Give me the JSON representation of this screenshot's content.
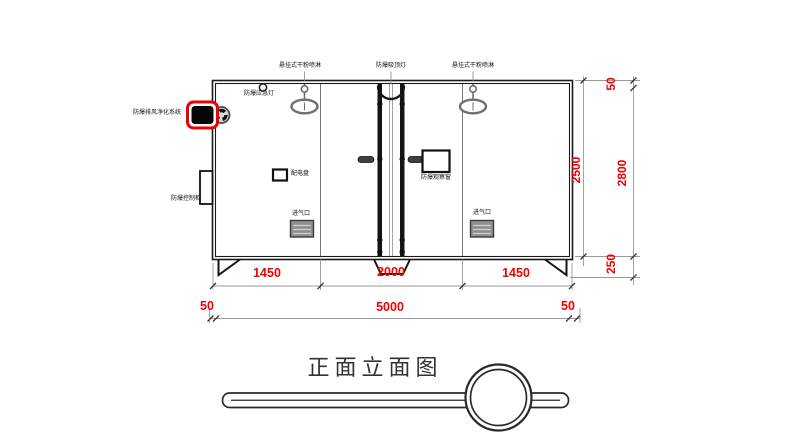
{
  "title": "正面立面图",
  "equipment_labels": {
    "sprinkler_left": "悬挂式干粉喷淋",
    "ceiling_lamp": "防爆吸顶灯",
    "sprinkler_right": "悬挂式干粉喷淋",
    "emergency_lamp": "防爆应急灯",
    "exhaust_purifier": "防爆排风净化系统",
    "control_cabinet": "防爆控制柜",
    "distribution_panel": "配电盘",
    "observation_window": "防爆观察窗",
    "air_inlet_left": "进气口",
    "air_inlet_right": "进气口"
  },
  "dimensions": {
    "bay_left": "1450",
    "bay_center": "2000",
    "bay_right": "1450",
    "overhang_left": "50",
    "total_width": "5000",
    "overhang_right": "50",
    "body_height": "2500",
    "roof_offset": "50",
    "total_height": "2800",
    "base_height": "250"
  },
  "colors": {
    "dimension_text": "#f20000",
    "line": "#1a1a1a",
    "grey_fixture": "#6f6f6f",
    "highlight_outline": "#ee0000"
  }
}
